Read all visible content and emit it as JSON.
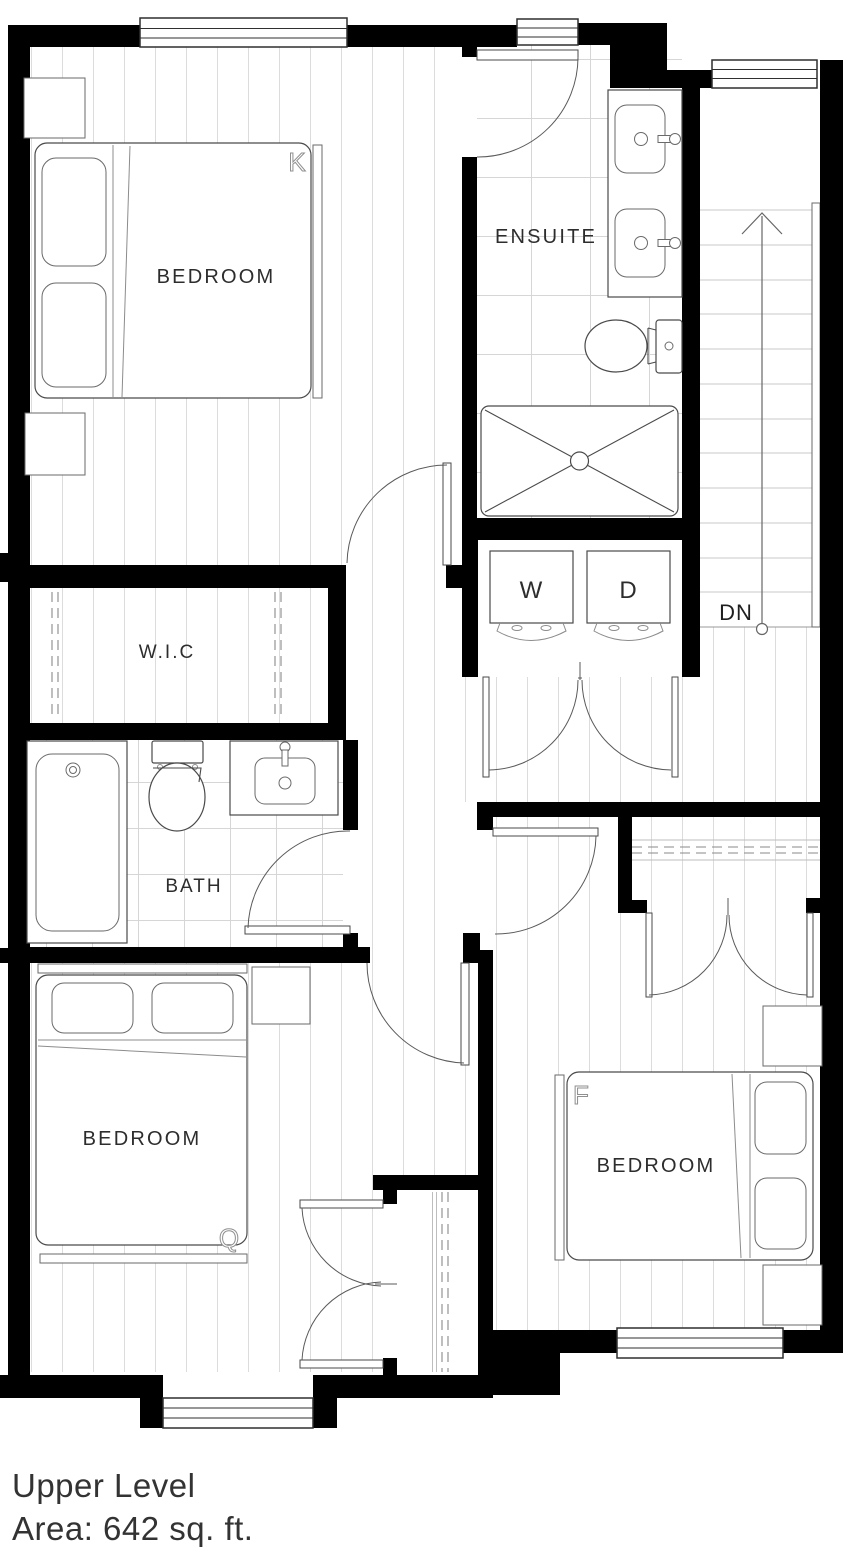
{
  "plan": {
    "rooms": {
      "bedroom_top": {
        "label": "BEDROOM",
        "bed_type": "K"
      },
      "ensuite": {
        "label": "ENSUITE"
      },
      "wic": {
        "label": "W.I.C"
      },
      "bath": {
        "label": "BATH"
      },
      "bedroom_left": {
        "label": "BEDROOM",
        "bed_type": "Q"
      },
      "bedroom_right": {
        "label": "BEDROOM",
        "bed_type": "F"
      },
      "laundry": {
        "washer": "W",
        "dryer": "D"
      },
      "stairs": {
        "direction_label": "DN"
      }
    },
    "colors": {
      "wall": "#000000",
      "fixture_line": "#4a4a4a",
      "floor_line": "#dcdcdc",
      "label_text": "#2d2d2d",
      "bed_letter": "#8f8f8f"
    }
  },
  "footer": {
    "title": "Upper Level",
    "area": "Area: 642 sq. ft."
  }
}
